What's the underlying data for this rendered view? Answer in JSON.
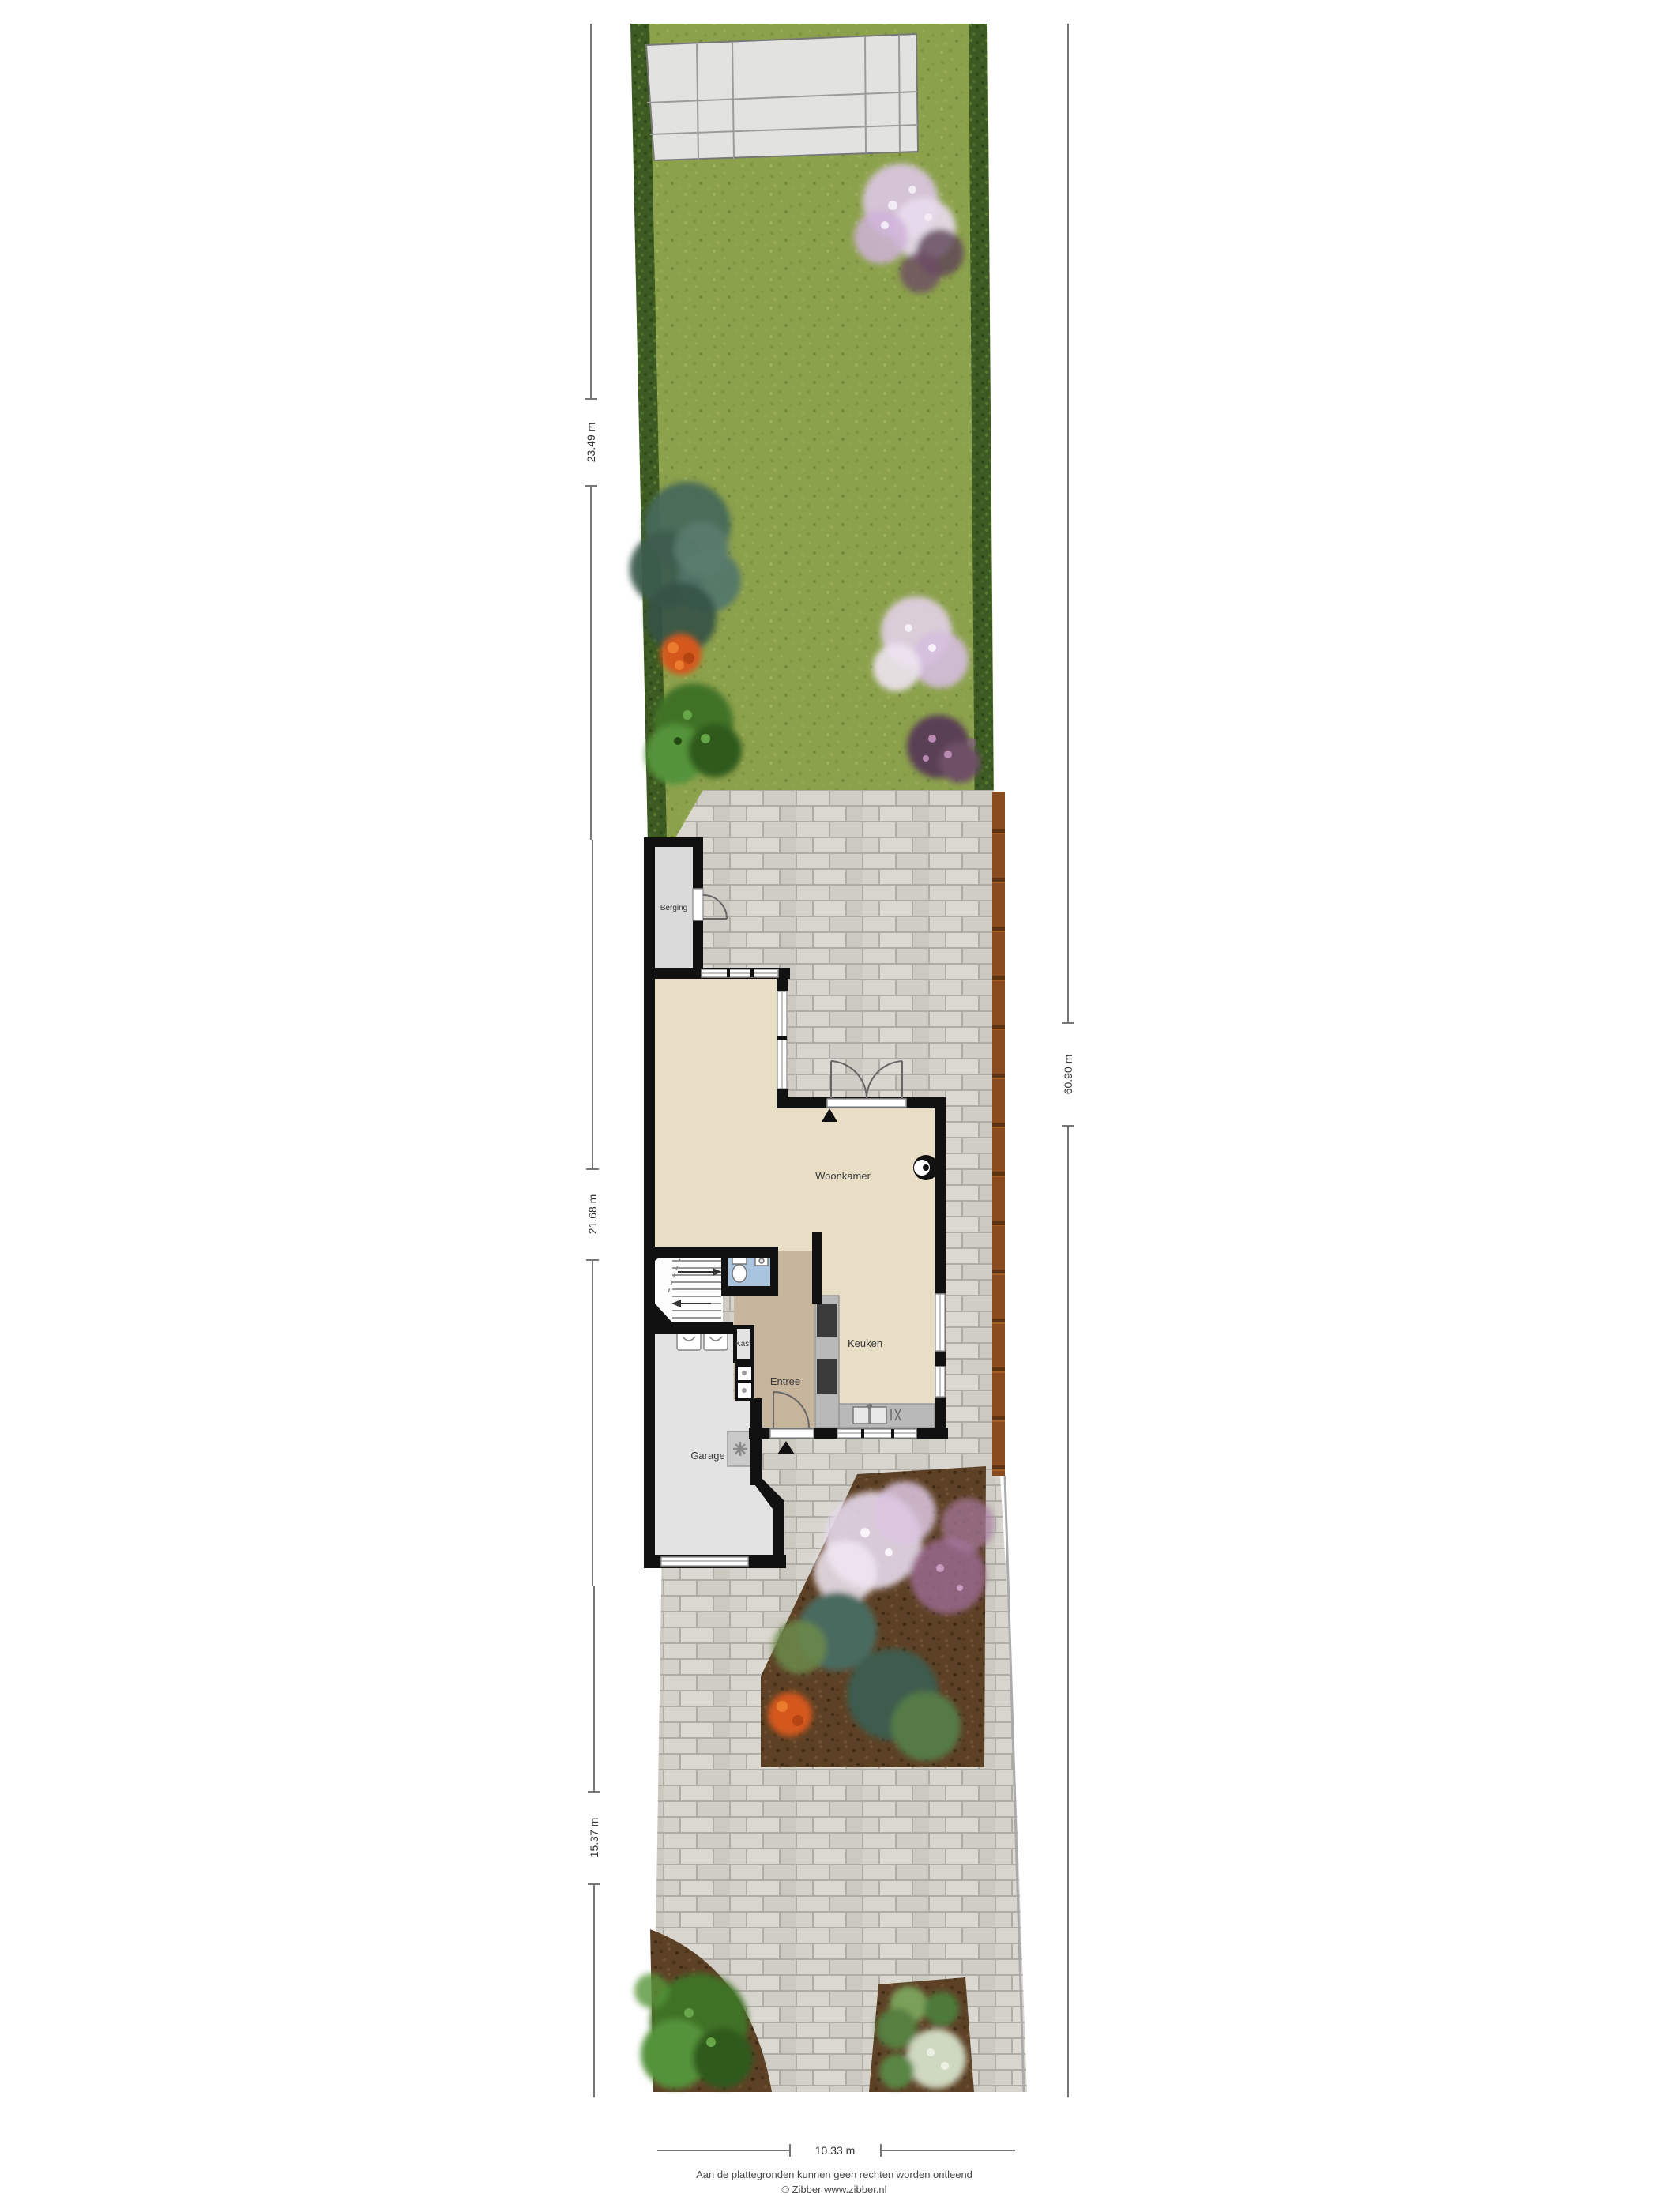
{
  "document": {
    "kind": "site-plan-floorplan",
    "floor": "ground-floor-with-garden"
  },
  "rooms": {
    "berging": "Berging",
    "woonkamer": "Woonkamer",
    "keuken": "Keuken",
    "entree": "Entree",
    "kast": "Kast",
    "garage": "Garage"
  },
  "dimensions": {
    "garden_depth": "23.49 m",
    "house_depth": "21.68 m",
    "front_depth": "15.37 m",
    "total_depth": "60.90 m",
    "plot_width": "10.33 m"
  },
  "footer": {
    "disclaimer": "Aan de plattegronden kunnen geen rechten worden ontleend",
    "credit": "© Zibber www.zibber.nl"
  },
  "palette": {
    "grass": "#8ca14c",
    "hedge": "#3c5a21",
    "paving_brick": "#d6d4cb",
    "patio_slab": "#e2e2e0",
    "soil": "#5d4126",
    "fence_wood": "#8a4b1e",
    "wall": "#111111",
    "floor_living": "#e7dec5",
    "floor_entree": "#c7b49c",
    "floor_toilet": "#a9c4de",
    "floor_garage": "#e3e3e3",
    "floor_berging": "#dadada",
    "counter": "#b9b9b9",
    "appliance": "#3b3b3b",
    "blossom_pink": "#e6d9ea",
    "flower_orange": "#d4581e"
  },
  "garden_features": [
    "lawn",
    "left-hedge",
    "right-hedge",
    "patio-slabs",
    "conifer-tree",
    "orange-flowers",
    "green-shrub",
    "blossom-tree",
    "purple-shrub"
  ],
  "front_features": [
    "brick-driveway",
    "wood-fence",
    "flower-bed-large",
    "flower-bed-left",
    "flower-bed-right",
    "blossom-tree",
    "teal-shrubs",
    "orange-flowers",
    "green-bush"
  ]
}
